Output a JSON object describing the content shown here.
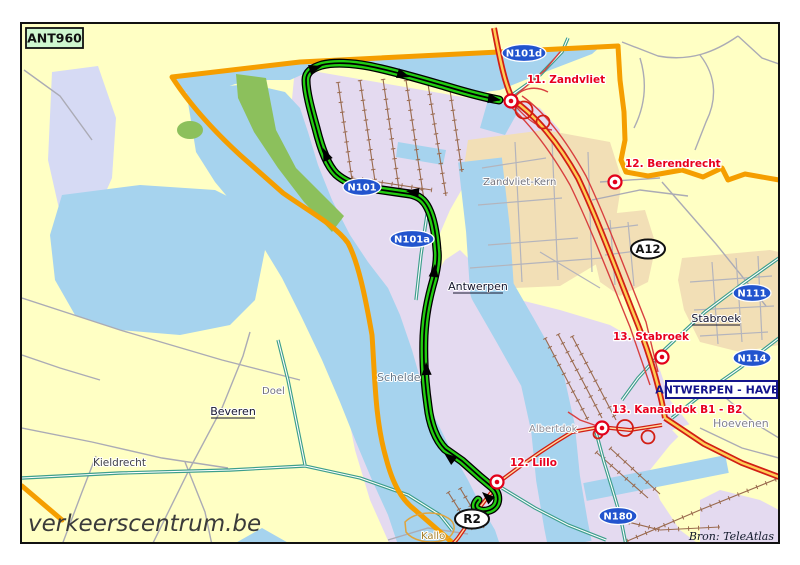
{
  "map": {
    "title_code": "ANT960",
    "watermark": "verkeerscentrum.be",
    "source_credit": "Bron: TeleAtlas",
    "area_box_label": "ANTWERPEN - HAVEN",
    "road_labels": {
      "n101": "N101",
      "n101a": "N101a",
      "n101d": "N101d",
      "n111": "N111",
      "n114": "N114",
      "n180": "N180",
      "a12": "A12",
      "r2": "R2"
    },
    "route_points": [
      {
        "label": "11. Zandvliet"
      },
      {
        "label": "12. Berendrecht"
      },
      {
        "label": "13. Stabroek"
      },
      {
        "label": "13. Kanaaldok B1 - B2"
      },
      {
        "label": "12. Lillo"
      }
    ],
    "places": {
      "zandvliet_kern": "Zandvliet-Kern",
      "antwerpen": "Antwerpen",
      "stabroek": "Stabroek",
      "beveren": "Beveren",
      "doel": "Doel",
      "kieldrecht": "Kieldrecht",
      "hoevenen": "Hoevenen",
      "albertdok": "Albertdok",
      "schelde": "Schelde",
      "kallo": "Kallo"
    },
    "colors": {
      "route_green": "#22CC11",
      "boundary_orange": "#F59E00",
      "motorway_red": "#D21E14",
      "water_blue": "#A6D3EE",
      "harbor_lavender": "#E4DAF0",
      "land_yellow": "#FFFFC4",
      "urban_beige": "#F2DFB6",
      "road_label_blue": "#2254CE",
      "point_red": "#E2001A"
    }
  }
}
